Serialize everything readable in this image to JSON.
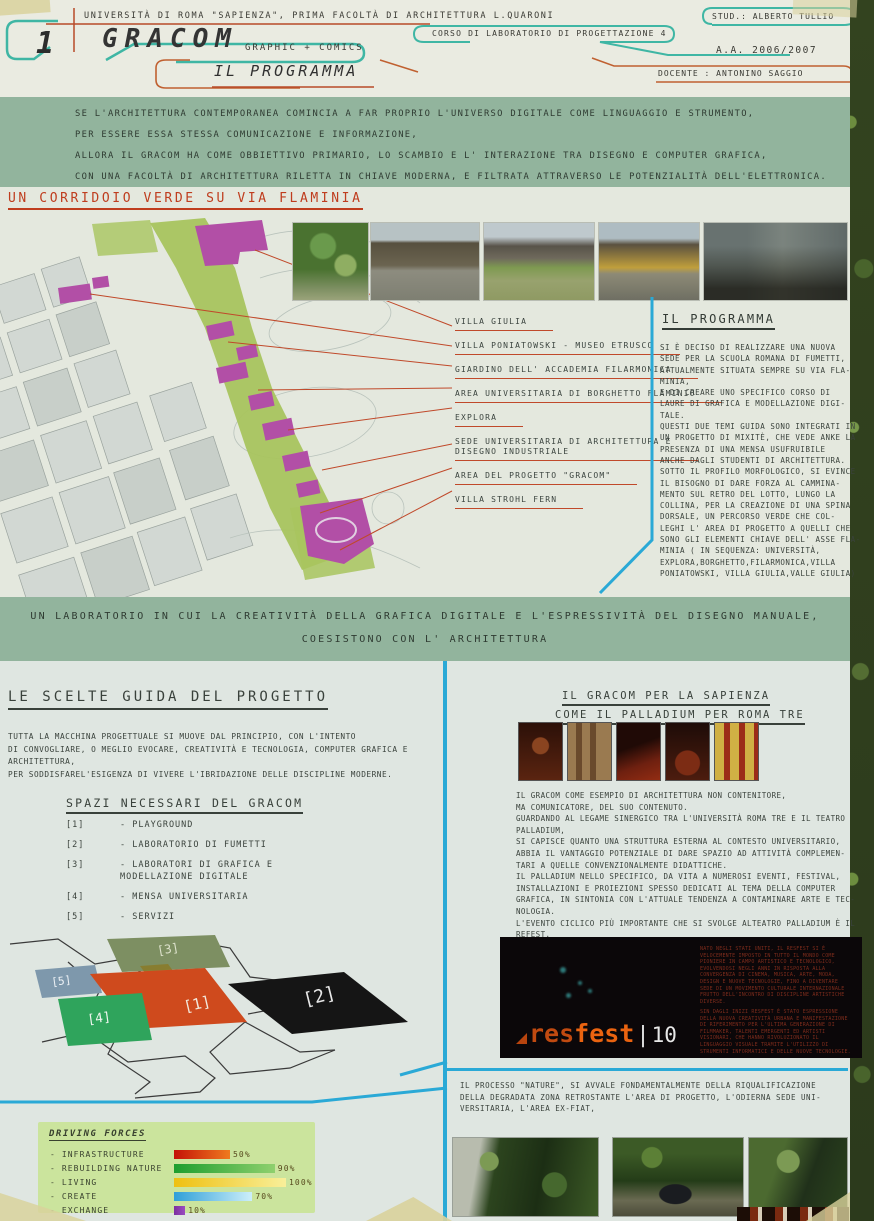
{
  "header": {
    "panel_number": "1",
    "university_line": "UNIVERSITÀ DI ROMA \"SAPIENZA\",  PRIMA FACOLTÀ DI ARCHITETTURA L.QUARONI",
    "logo": "GRACOM",
    "logo_subtitle": "GRAPHIC + COMICS",
    "page_title": "IL PROGRAMMA",
    "course": "CORSO DI LABORATORIO DI PROGETTAZIONE 4",
    "student": "STUD.: ALBERTO TULLIO",
    "academic_year": "A.A. 2006/2007",
    "teacher": "DOCENTE : ANTONINO SAGGIO"
  },
  "intro_band": {
    "lines": [
      "SE L'ARCHITETTURA CONTEMPORANEA COMINCIA A FAR PROPRIO L'UNIVERSO DIGITALE COME LINGUAGGIO E STRUMENTO,",
      "PER ESSERE ESSA STESSA COMUNICAZIONE E INFORMAZIONE,",
      "ALLORA IL GRACOM HA COME OBBIETTIVO PRIMARIO, LO SCAMBIO E L' INTERAZIONE TRA DISEGNO E COMPUTER GRAFICA,",
      "CON UNA FACOLTÀ DI ARCHITETTURA RILETTA IN CHIAVE MODERNA, E FILTRATA ATTRAVERSO LE POTENZIALITÀ DELL'ELETTRONICA."
    ]
  },
  "corridor_section": {
    "heading": "UN CORRIDOIO VERDE SU VIA FLAMINIA",
    "map_labels": [
      "VILLA GIULIA",
      "VILLA PONIATOWSKI - MUSEO ETRUSCO",
      "GIARDINO DELL' ACCADEMIA FILARMONICA",
      "AREA UNIVERSITARIA DI BORGHETTO FLAMINIO",
      "EXPLORA",
      "SEDE UNIVERSITARIA DI ARCHITETTURA E\nDISEGNO INDUSTRIALE",
      "AREA DEL PROGETTO \"GRACOM\"",
      "VILLA STROHL FERN"
    ],
    "programma": {
      "heading": "IL PROGRAMMA",
      "body": "SI È DECISO DI REALIZZARE UNA NUOVA\nSEDE PER LA SCUOLA ROMANA DI FUMETTI,\nATTUALMENTE SITUATA SEMPRE SU VIA FLA-\nMINIA,\nE DI CREARE UNO SPECIFICO CORSO DI\nLAURE DI GRAFICA E MODELLAZIONE DIGI-\nTALE.\nQUESTI DUE TEMI GUIDA SONO INTEGRATI IN\nUN PROGETTO DI MIXITÈ, CHE VEDE ANKE LA\nPRESENZA DI UNA MENSA USUFRUIBILE\nANCHE DAGLI STUDENTI DI ARCHITETTURA.\nSOTTO IL PROFILO MORFOLOGICO, SI EVINCE\nIL BISOGNO DI DARE FORZA AL CAMMINA-\nMENTO SUL RETRO DEL LOTTO, LUNGO LA\nCOLLINA, PER LA CREAZIONE DI UNA SPINA\nDORSALE, UN PERCORSO VERDE CHE COL-\nLEGHI L' AREA DI PROGETTO A QUELLI CHE\nSONO GLI ELEMENTI CHIAVE DELL' ASSE FLA-\nMINIA ( IN SEQUENZA: UNIVERSITÀ,\nEXPLORA,BORGHETTO,FILARMONICA,VILLA\nPONIATOWSKI, VILLA GIULIA,VALLE GIULIA)"
    }
  },
  "middle_band": {
    "line1": "UN LABORATORIO IN CUI LA CREATIVITÀ DELLA GRAFICA DIGITALE E L'ESPRESSIVITÀ DEL DISEGNO MANUALE,",
    "line2": "COESISTONO CON L' ARCHITETTURA"
  },
  "left_column": {
    "heading": "LE SCELTE GUIDA DEL PROGETTO",
    "body": "TUTTA LA MACCHINA PROGETTUALE SI MUOVE DAL PRINCIPIO, CON L'INTENTO\nDI CONVOGLIARE, O MEGLIO EVOCARE, CREATIVITÀ E TECNOLOGIA, COMPUTER GRAFICA E\nARCHITETTURA,\nPER SODDISFAREL'ESIGENZA DI VIVERE L'IBRIDAZIONE DELLE DISCIPLINE MODERNE.",
    "spazi": {
      "heading": "SPAZI NECESSARI DEL GRACOM",
      "items": [
        {
          "num": "[1]",
          "label": "- PLAYGROUND"
        },
        {
          "num": "[2]",
          "label": "- LABORATORIO DI FUMETTI"
        },
        {
          "num": "[3]",
          "label": "- LABORATORI DI GRAFICA E\nMODELLAZIONE DIGITALE"
        },
        {
          "num": "[4]",
          "label": "- MENSA UNIVERSITARIA"
        },
        {
          "num": "[5]",
          "label": "- SERVIZI"
        }
      ]
    },
    "diagram": {
      "labels": [
        "[1]",
        "[2]",
        "[3]",
        "[4]",
        "[5]"
      ],
      "colors": {
        "block1": "#cf4a1d",
        "block2": "#151515",
        "block3": "#7d8f62",
        "block4": "#2fa45c",
        "block5": "#7e98ac"
      }
    }
  },
  "driving_forces": {
    "title": "DRIVING FORCES",
    "chart_data": {
      "type": "bar",
      "categories": [
        "INFRASTRUCTURE",
        "REBUILDING NATURE",
        "LIVING",
        "CREATE",
        "EXCHANGE"
      ],
      "values": [
        50,
        90,
        100,
        70,
        10
      ],
      "title": "DRIVING FORCES",
      "xlabel": "",
      "ylabel": "",
      "xlim": [
        0,
        100
      ],
      "grid": false,
      "legend": false
    },
    "rows": [
      {
        "label": "- INFRASTRUCTURE",
        "pct": "50%",
        "value": 50,
        "c1": "#c41208",
        "c2": "#ef7a1e"
      },
      {
        "label": "- REBUILDING NATURE",
        "pct": "90%",
        "value": 90,
        "c1": "#1d9e2e",
        "c2": "#8fd06e"
      },
      {
        "label": "- LIVING",
        "pct": "100%",
        "value": 100,
        "c1": "#eec011",
        "c2": "#f8ef9a"
      },
      {
        "label": "- CREATE",
        "pct": "70%",
        "value": 70,
        "c1": "#2f9fd8",
        "c2": "#cdeffa"
      },
      {
        "label": "- EXCHANGE",
        "pct": "10%",
        "value": 10,
        "c1": "#7c2fa0",
        "c2": "#9a4ec0"
      }
    ]
  },
  "right_column": {
    "heading_line1": "IL GRACOM PER LA SAPIENZA",
    "heading_line2": "COME IL PALLADIUM PER ROMA TRE",
    "body": "IL GRACOM COME ESEMPIO DI ARCHITETTURA NON CONTENITORE,\nMA COMUNICATORE, DEL  SUO CONTENUTO.\nGUARDANDO AL LEGAME SINERGICO TRA L'UNIVERSITÀ ROMA TRE E IL TEATRO\nPALLADIUM,\nSI CAPISCE QUANTO UNA STRUTTURA ESTERNA AL CONTESTO UNIVERSITARIO,\nABBIA IL VANTAGGIO POTENZIALE DI DARE SPAZIO AD ATTIVITÀ COMPLEMEN-\nTARI A QUELLE CONVENZIONALMENTE DIDATTICHE.\nIL PALLADIUM NELLO SPECIFICO, DA VITA A NUMEROSI EVENTI, FESTIVAL,\nINSTALLAZIONI E PROIEZIONI SPESSO DEDICATI AL TEMA DELLA COMPUTER\nGRAFICA, IN SINTONIA CON L'ATTUALE TENDENZA A CONTAMINARE ARTE E TEC-\nNOLOGIA.\nL'EVENTO CICLICO PIÙ IMPORTANTE CHE SI SVOLGE ALTEATRO PALLADIUM È IL\nREFEST.",
    "resfest": {
      "logo_res": "res",
      "logo_fest": "fest",
      "logo_bar": "|",
      "logo_num": "10",
      "text1": "NATO NEGLI STATI UNITI, IL RESFEST SI È VELOCEMENTE IMPOSTO IN TUTTO IL MONDO COME PIONIERE IN CAMPO ARTISTICO E TECNOLOGICO, EVOLVENDOSI NEGLI ANNI IN RISPOSTA ALLA CONVERGENZA DI CINEMA, MUSICA, ARTE, MODA, DESIGN E NUOVE TECNOLOGIE, FINO A DIVENTARE SEDE DI UN MOVIMENTO CULTURALE INTERNAZIONALE FRUTTO DELL'INCONTRO DI DISCIPLINE ARTISTICHE DIVERSE.",
      "text2": "SIN DAGLI INIZI RESFEST È STATO ESPRESSIONE DELLA NUOVA CREATIVITÀ URBANA E MANIFESTAZIONE DI RIFERIMENTO PER L'ULTIMA GENERAZIONE DI FILMMAKER, TALENTI EMERGENTI ED ARTISTI VISIONARI, CHE HANNO RIVOLUZIONATO IL LINGUAGGIO VISUALE TRAMITE L'UTILIZZO DI STRUMENTI INFORMATICI E DELLE NUOVE TECNOLOGIE."
    },
    "nature_text": "IL PROCESSO \"NATURE\", SI AVVALE FONDAMENTALMENTE DELLA RIQUALIFICAZIONE\nDELLA DEGRADATA ZONA RETROSTANTE L'AREA DI PROGETTO, L'ODIERNA SEDE UNI-\nVERSITARIA, L'AREA EX-FIAT,"
  },
  "accent_colors": {
    "cyan_line": "#2aa9d6",
    "red_accent": "#c0492a",
    "teal_outline": "#3fb6a4",
    "band_green": "#92b49d",
    "map_green": "#a8c45e",
    "map_magenta": "#b24fa6"
  }
}
